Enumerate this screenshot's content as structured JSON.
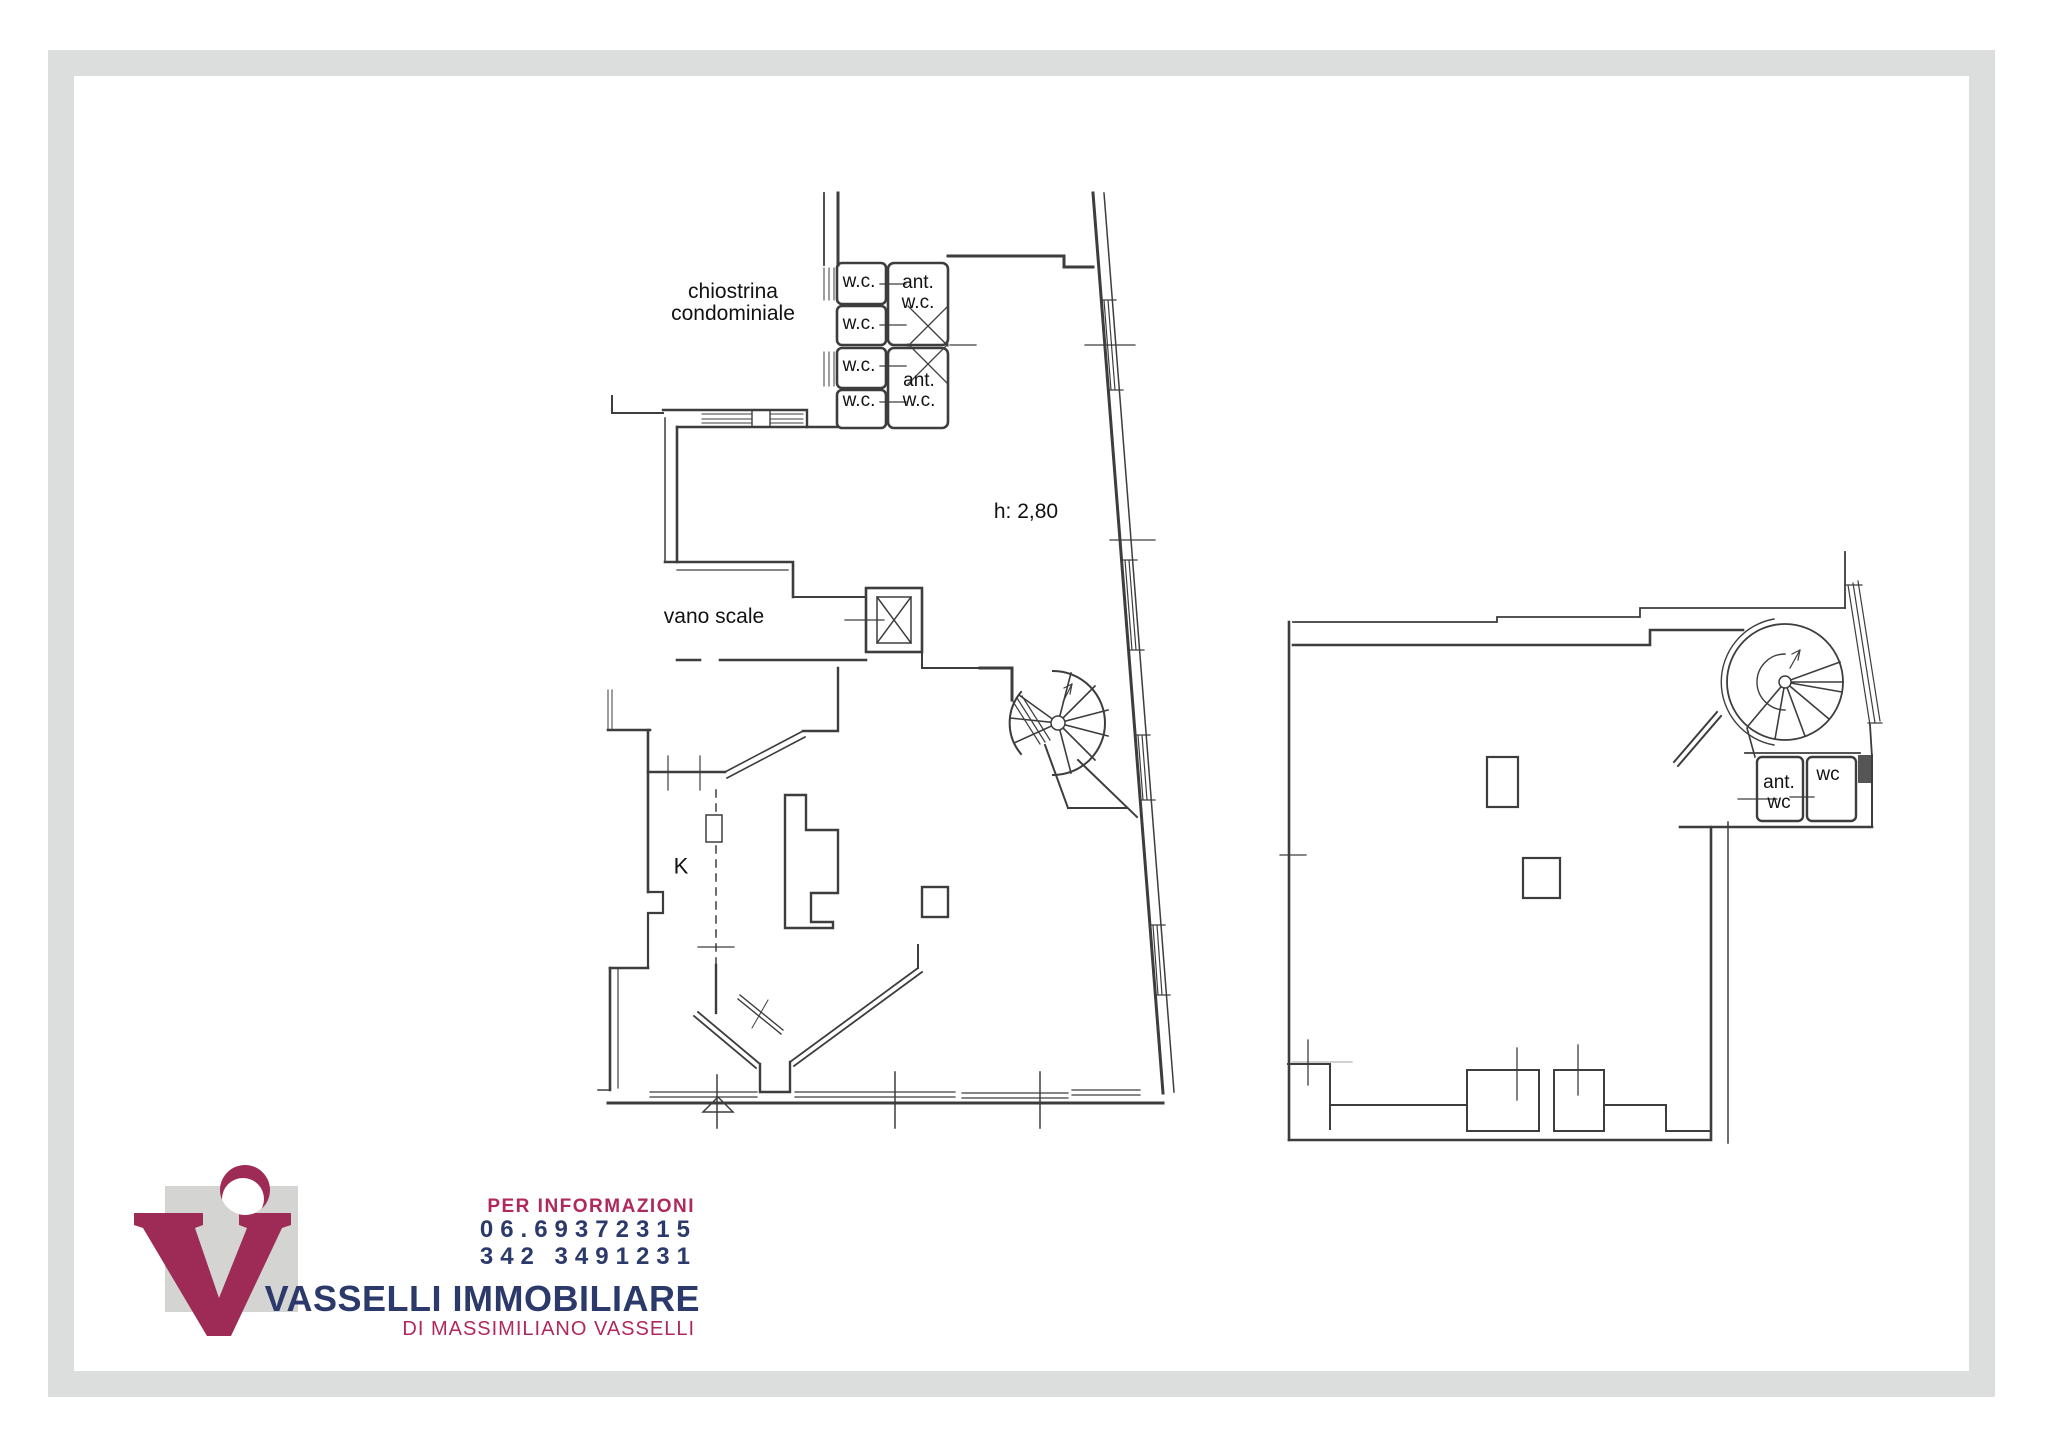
{
  "frame": {
    "color": "#dcdede"
  },
  "plans": {
    "left": {
      "chiostrina_line1": "chiostrina",
      "chiostrina_line2": "condominiale",
      "wc_label": "w.c.",
      "ant_label": "ant.",
      "ant_wc_line2": "w.c.",
      "height_note": "h: 2,80",
      "stairwell_label": "vano scale",
      "kitchen_label": "K"
    },
    "right": {
      "ant_label": "ant.",
      "ant_wc_line2": "wc",
      "wc_label": "wc"
    }
  },
  "footer": {
    "info_label": "PER INFORMAZIONI",
    "phone_primary": "06.69372315",
    "phone_mobile": "342 3491231",
    "company_name": "VASSELLI IMMOBILIARE",
    "company_subtitle": "DI MASSIMILIANO VASSELLI",
    "colors": {
      "magenta": "#a82a5a",
      "navy": "#2b3a6b",
      "logo_gray": "#d4d4d2"
    }
  }
}
